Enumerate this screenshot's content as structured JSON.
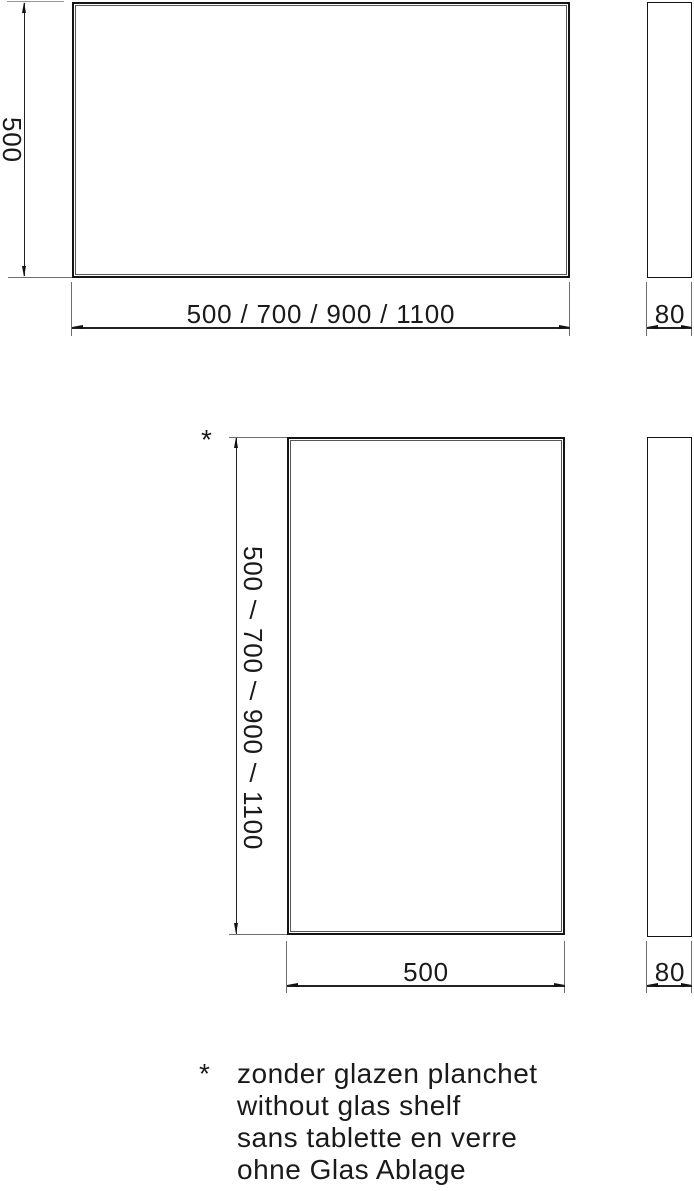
{
  "colors": {
    "line": "#141414",
    "thin_line": "#565656",
    "dim_line": "#222222",
    "extension_line": "#6e6e6e",
    "background": "#ffffff"
  },
  "drawing": {
    "front_landscape": {
      "height_label": "500",
      "width_label": "500 / 700 / 900 / 1100"
    },
    "side_landscape": {
      "depth_label": "80"
    },
    "front_portrait": {
      "note_marker": "*",
      "height_sizes": [
        "500",
        "700",
        "900",
        "1100"
      ],
      "separator": "/",
      "width_label": "500"
    },
    "side_portrait": {
      "depth_label": "80"
    }
  },
  "footnote": {
    "marker": "*",
    "lines": [
      "zonder glazen planchet",
      "without glas shelf",
      "sans tablette en verre",
      "ohne Glas Ablage"
    ]
  }
}
